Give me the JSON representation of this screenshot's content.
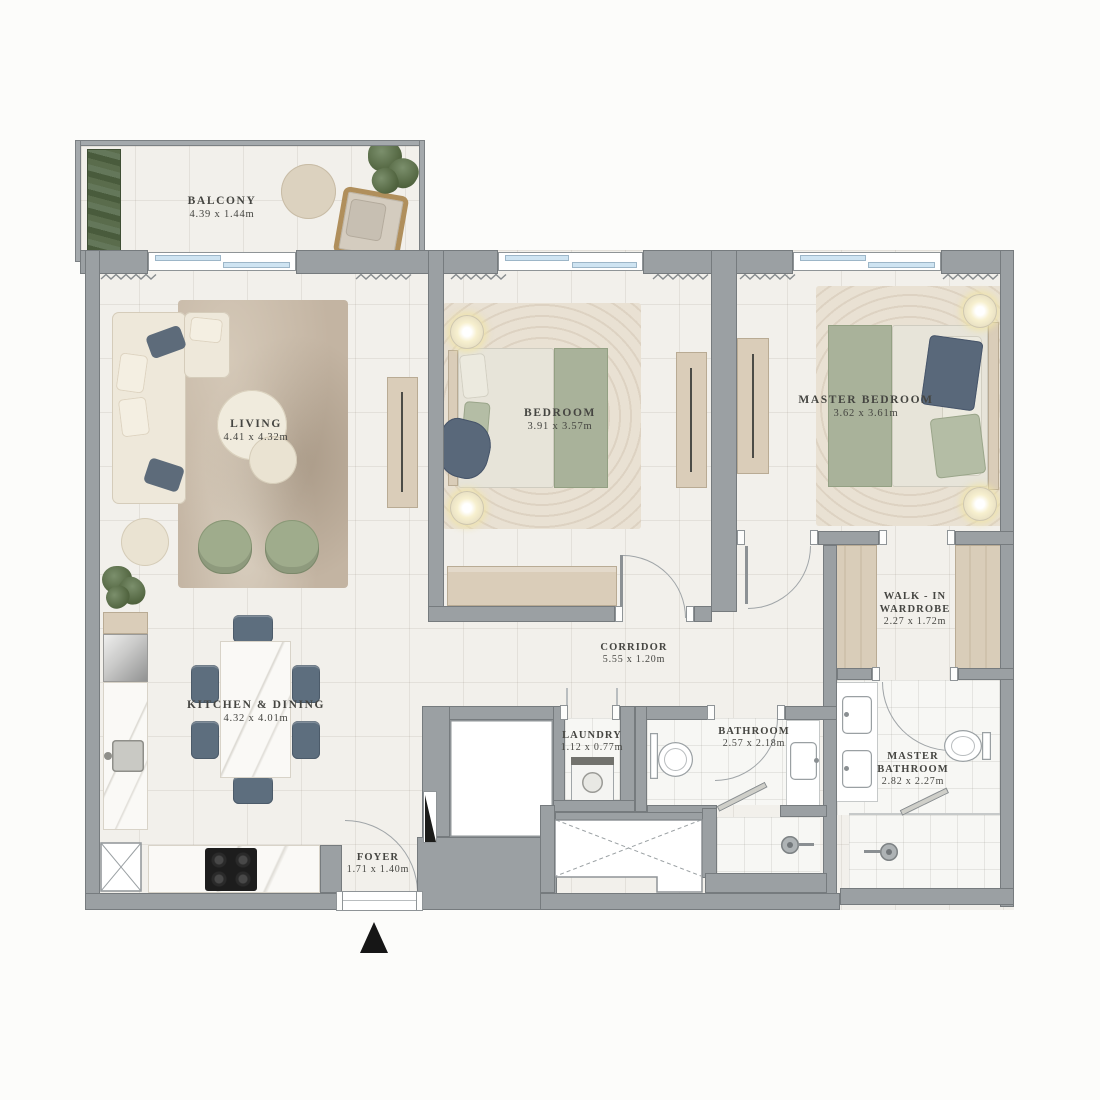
{
  "palette": {
    "wall": "#9ba0a3",
    "wall_outline": "#767b7e",
    "floor": "#f2f0eb",
    "wood": "#dacdb9",
    "marble": "#faf9f6",
    "sage_green": "#a9b29a",
    "olive_green": "#9fac8c",
    "navy": "#5d6b7a",
    "cream_sofa": "#eee8da",
    "window_glass": "#cfe4f2",
    "rug_brown": "#c3b4a2",
    "rug_beige": "#e9e1d3",
    "label_text": "#454541",
    "entrance_marker": "#161616"
  },
  "icons": {
    "entrance_marker": "triangle-up",
    "shaft_void": "crossed-box",
    "door_swing": "quarter-arc",
    "window_squiggle": "zigzag"
  },
  "plan": {
    "balcony": {
      "name": "BALCONY",
      "dims": "4.39 x 1.44m"
    },
    "living": {
      "name": "LIVING",
      "dims": "4.41 x 4.32m"
    },
    "bedroom": {
      "name": "BEDROOM",
      "dims": "3.91 x 3.57m"
    },
    "master_bedroom": {
      "name": "MASTER BEDROOM",
      "dims": "3.62 x 3.61m"
    },
    "walk_in_wardrobe": {
      "line1": "WALK - IN",
      "line2": "WARDROBE",
      "dims": "2.27 x 1.72m"
    },
    "corridor": {
      "name": "CORRIDOR",
      "dims": "5.55 x 1.20m"
    },
    "kitchen_dining": {
      "name": "KITCHEN & DINING",
      "dims": "4.32 x 4.01m"
    },
    "laundry": {
      "name": "LAUNDRY",
      "dims": "1.12 x 0.77m"
    },
    "bathroom": {
      "name": "BATHROOM",
      "dims": "2.57 x 2.18m"
    },
    "master_bathroom": {
      "line1": "MASTER",
      "line2": "BATHROOM",
      "dims": "2.82 x 2.27m"
    },
    "foyer": {
      "name": "FOYER",
      "dims": "1.71 x 1.40m"
    }
  }
}
